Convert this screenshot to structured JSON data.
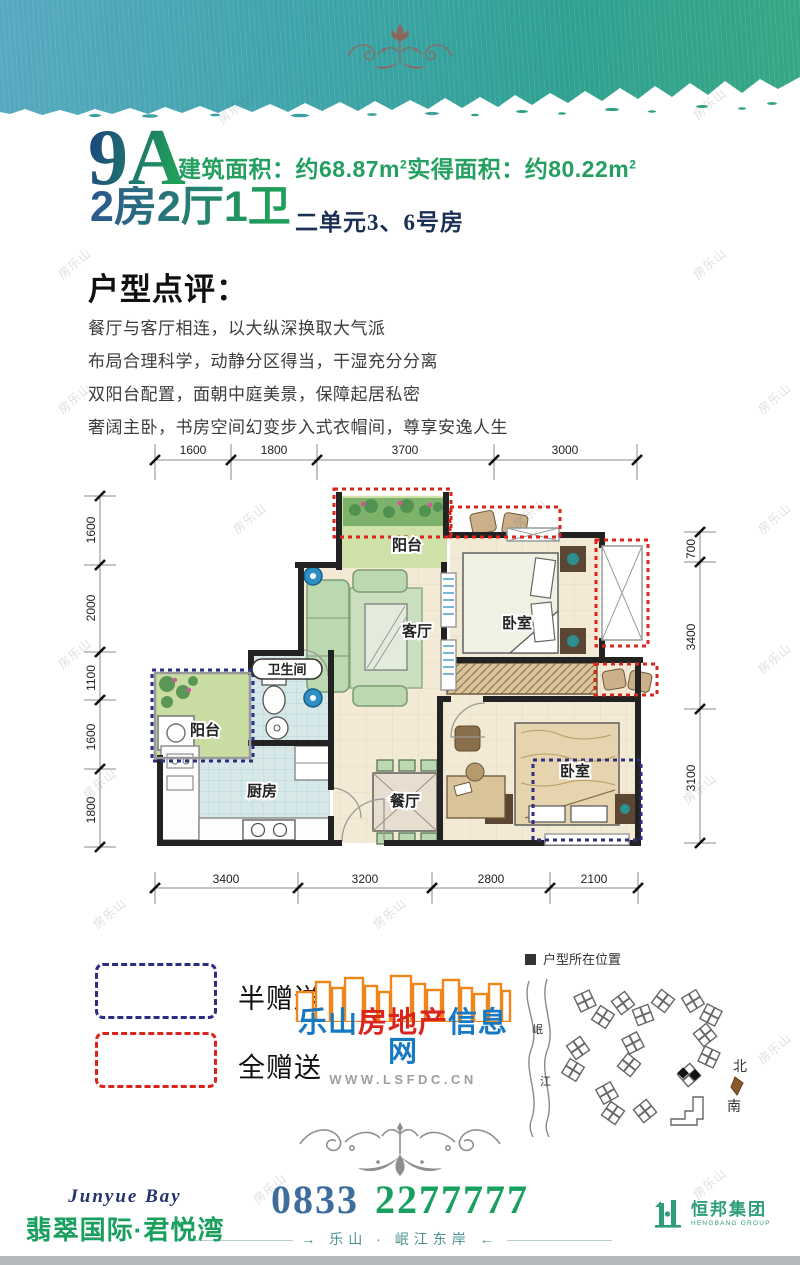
{
  "title": {
    "unit_code": "9A",
    "built_label": "建筑面积：约",
    "built_value": "68.87m",
    "built_sup": "2",
    "actual_label": "实得面积：约",
    "actual_value": "80.22m",
    "actual_sup": "2",
    "layout": "2房2厅1卫",
    "unit_rooms": "二单元3、6号房"
  },
  "review": {
    "heading": "户型点评：",
    "lines": [
      "餐厅与客厅相连，以大纵深换取大气派",
      "布局合理科学，动静分区得当，干湿充分分离",
      "双阳台配置，面朝中庭美景，保障起居私密",
      "奢阔主卧，书房空间幻变步入式衣帽间，尊享安逸人生"
    ]
  },
  "floorplan": {
    "dims_top": [
      "1600",
      "1800",
      "3700",
      "3000"
    ],
    "dims_left": [
      "1600",
      "2000",
      "1100",
      "1600",
      "1800"
    ],
    "dims_right": [
      "700",
      "3400",
      "3100"
    ],
    "dims_bottom": [
      "3400",
      "3200",
      "2800",
      "2100"
    ],
    "rooms": {
      "balcony_top": "阳台",
      "living": "客厅",
      "bedroom_top": "卧室",
      "bathroom": "卫生间",
      "balcony_left": "阳台",
      "kitchen": "厨房",
      "dining": "餐厅",
      "bedroom_bottom": "卧室"
    }
  },
  "legend": {
    "half_gift": "半赠送",
    "full_gift": "全赠送",
    "half_gift_color": "#2b2e83",
    "full_gift_color": "#d9251c"
  },
  "portal": {
    "name_part1": "乐山",
    "name_part2": "房地产",
    "name_part3": "信息网",
    "url": "WWW.LSFDC.CN",
    "color_blue": "#1779c4",
    "color_red": "#d9251c",
    "color_orange": "#f08519"
  },
  "map": {
    "title": "户型所在位置",
    "river_char1": "岷",
    "river_char2": "江",
    "north": "北",
    "south": "南"
  },
  "contact": {
    "phone_part1": "0833",
    "phone_part2": "2277777",
    "arrow_left": "→",
    "arrow_right": "←",
    "tagline": "乐山 · 岷江东岸"
  },
  "brand": {
    "en": "Junyue Bay",
    "cn": "翡翠国际·君悦湾"
  },
  "group": {
    "cn": "恒邦集团",
    "en": "HENGBANG GROUP"
  },
  "watermark": "房乐山"
}
